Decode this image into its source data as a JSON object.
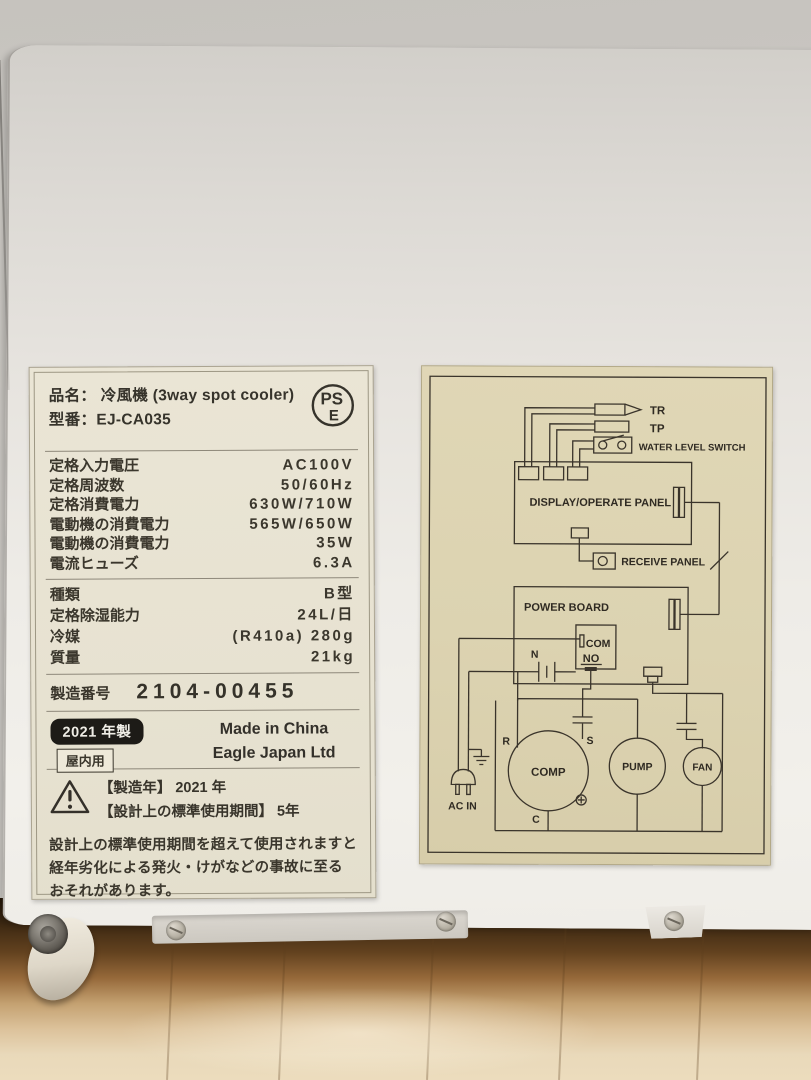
{
  "spec_label": {
    "product_row": {
      "label": "品名：",
      "value": "冷風機 (3way spot cooler)"
    },
    "model_row": {
      "label": "型番：",
      "value": "EJ-CA035"
    },
    "pse": {
      "top": "PS",
      "bottom": "E"
    },
    "ratings": [
      {
        "label": "定格入力電圧",
        "value": "AC100V"
      },
      {
        "label": "定格周波数",
        "value": "50/60Hz"
      },
      {
        "label": "定格消費電力",
        "value": "630W/710W"
      },
      {
        "label": "電動機の消費電力",
        "value": "565W/650W"
      },
      {
        "label": "電動機の消費電力",
        "value": "35W"
      },
      {
        "label": "電流ヒューズ",
        "value": "6.3A"
      }
    ],
    "details": [
      {
        "label": "種類",
        "value": "B型"
      },
      {
        "label": "定格除湿能力",
        "value": "24L/日"
      },
      {
        "label": "冷媒",
        "value": "(R410a) 280g"
      },
      {
        "label": "質量",
        "value": "21kg"
      }
    ],
    "serial": {
      "label": "製造番号",
      "value": "2104-00455"
    },
    "origin": {
      "year_badge": "2021 年製",
      "indoor_badge": "屋内用",
      "made_in": "Made in China",
      "company": "Eagle Japan Ltd"
    },
    "caution": {
      "mfg": "【製造年】 2021 年",
      "life": "【設計上の標準使用期間】 5年",
      "lines": [
        "設計上の標準使用期間を超えて使用されますと",
        "経年劣化による発火・けがなどの事故に至る",
        "おそれがあります。"
      ]
    }
  },
  "wiring_label": {
    "tr": "TR",
    "tp": "TP",
    "wls": "WATER LEVEL SWITCH",
    "display_panel": "DISPLAY/OPERATE PANEL",
    "receive_panel": "RECEIVE PANEL",
    "power_board": "POWER BOARD",
    "com": "COM",
    "no": "NO",
    "n": "N",
    "r": "R",
    "s": "S",
    "c": "C",
    "comp": "COMP",
    "pump": "PUMP",
    "fan": "FAN",
    "ac_in": "AC IN"
  },
  "colors": {
    "wall": "#cbc8c3",
    "appliance": "#efede8",
    "spec_label_bg": "#e8e3d3",
    "wiring_label_bg": "#dcd3b1",
    "diagram_line": "#3a342b",
    "floor_shadow": "#3c2812",
    "floor_wood": "#dcc29b",
    "badge_bg": "#1d1b17"
  }
}
